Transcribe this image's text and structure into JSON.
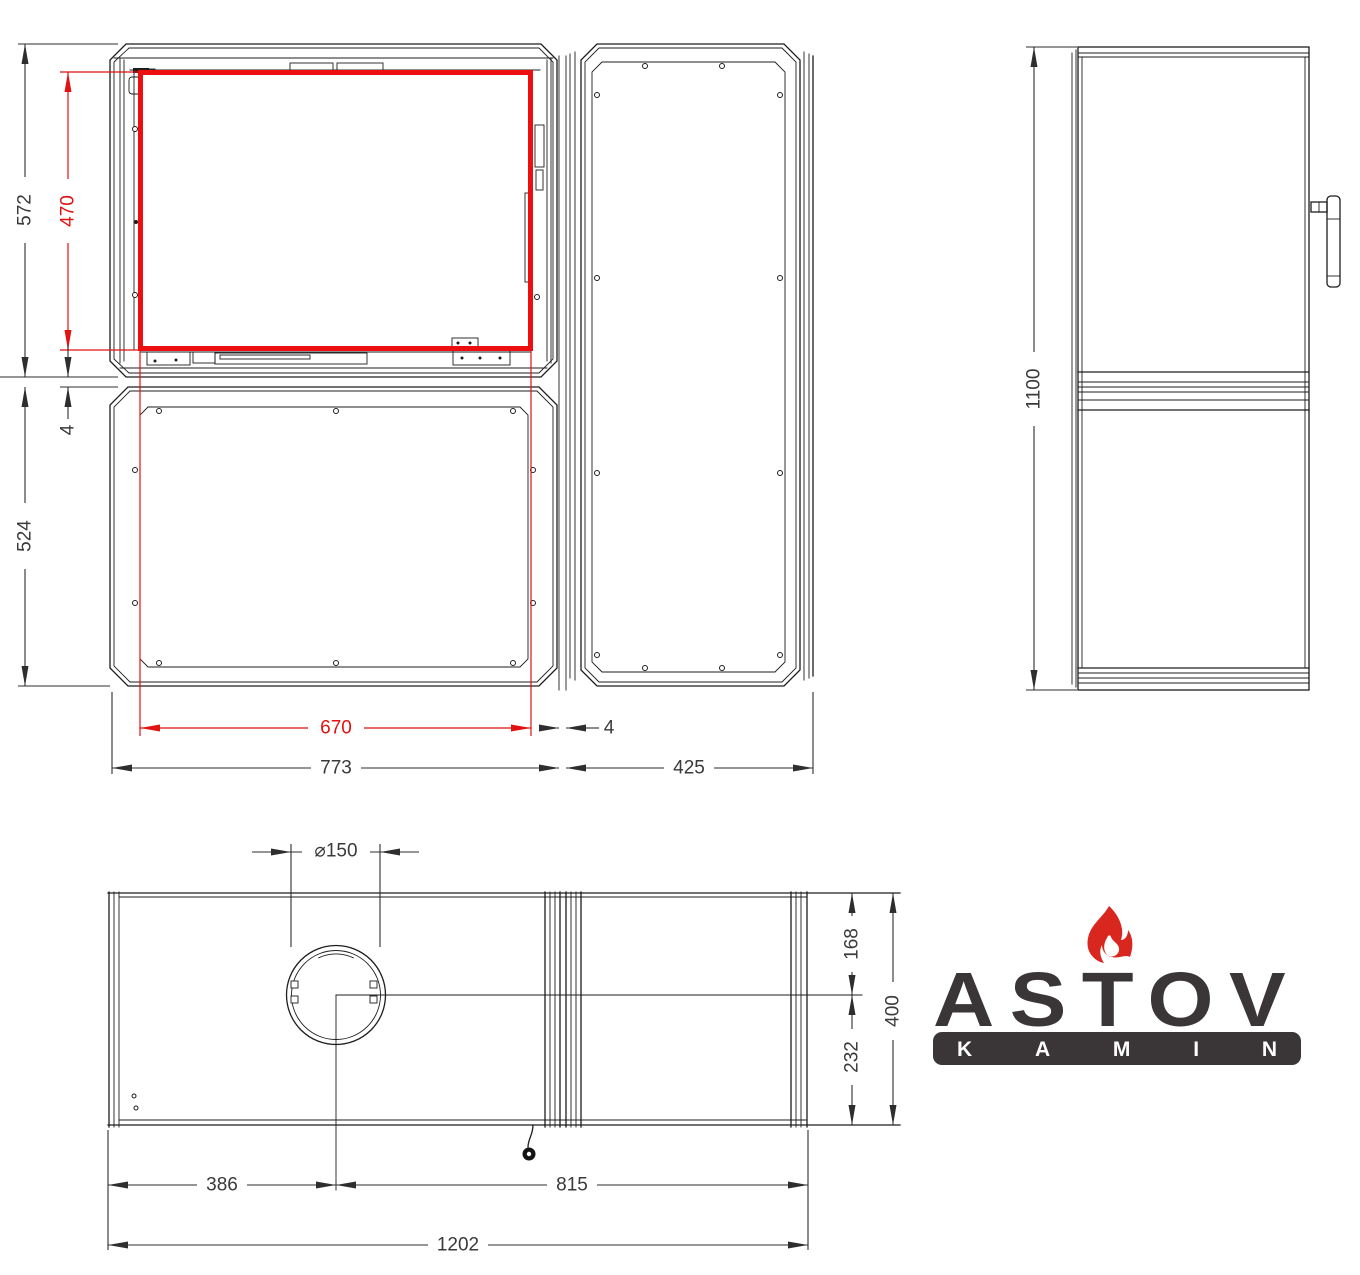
{
  "drawing": {
    "type": "technical-drawing",
    "product": "kamin fireplace insert — front, side and top views",
    "brand": {
      "name": "ASTOV",
      "subtitle": "KAMIN"
    },
    "colors": {
      "line": "#1d1d1d",
      "highlight_red": "#ed0f0f",
      "dimension_red": "#e01212",
      "logo_dark": "#3a3637",
      "flame_red": "#d9261f",
      "background": "#ffffff"
    },
    "views": {
      "front": {
        "label": "front view",
        "dims": {
          "top_module_height": "572",
          "glass_height": "470",
          "panel_gap_vertical": "4",
          "bottom_module_height": "524",
          "glass_width": "670",
          "total_width": "773",
          "panel_gap_horizontal": "4",
          "right_module_width": "425"
        }
      },
      "side": {
        "label": "side view",
        "dims": {
          "total_height": "1100"
        }
      },
      "top": {
        "label": "top view",
        "dims": {
          "flue_diameter": "⌀150",
          "flue_to_front": "168",
          "flue_to_rear": "232",
          "total_depth": "400",
          "left_to_flue_center": "386",
          "flue_center_to_right": "815",
          "total_width": "1202"
        }
      }
    }
  }
}
